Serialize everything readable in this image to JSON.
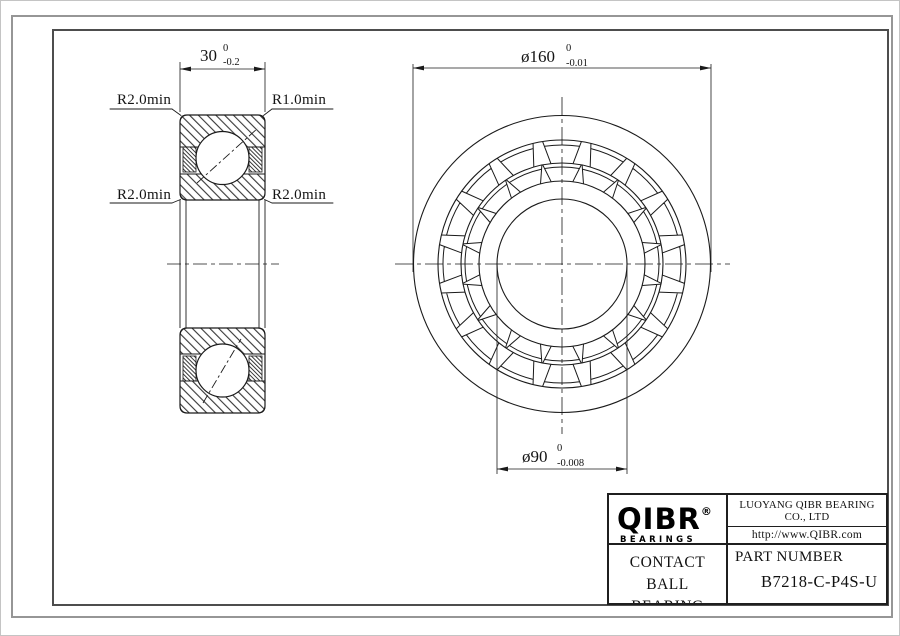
{
  "views": {
    "section": {
      "width_dim": {
        "value": "30",
        "tol_upper": "0",
        "tol_lower": "-0.2"
      },
      "labels": {
        "top_left": "R2.0min",
        "top_right": "R1.0min",
        "mid_left": "R2.0min",
        "mid_right": "R2.0min"
      }
    },
    "front": {
      "od_dim": {
        "value": "ø160",
        "tol_upper": "0",
        "tol_lower": "-0.01"
      },
      "bore_dim": {
        "value": "ø90",
        "tol_upper": "0",
        "tol_lower": "-0.008"
      }
    }
  },
  "title_block": {
    "brand": {
      "logo": "QIBR",
      "registered": "®",
      "tagline": "BEARINGS"
    },
    "company": {
      "name": "LUOYANG QIBR BEARING CO., LTD",
      "url": "http://www.QIBR.com"
    },
    "product": {
      "line1": "ANGULAR CONTACT",
      "line2": "BALL BEARING"
    },
    "part": {
      "label": "PART NUMBER",
      "number": "B7218-C-P4S-U"
    }
  }
}
